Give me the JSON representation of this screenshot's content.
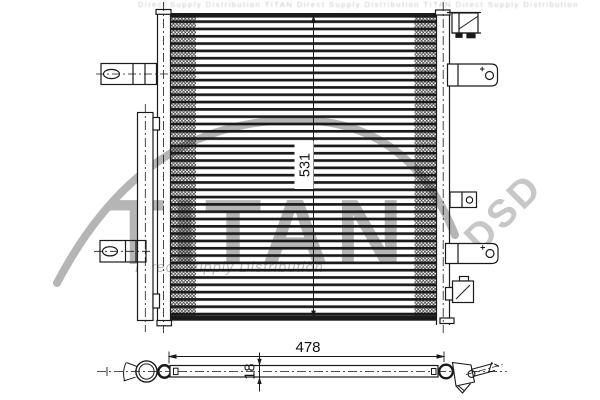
{
  "diagram": {
    "dimensions": {
      "height": "531",
      "width": "478",
      "depth": "18"
    }
  },
  "watermark": {
    "brand": "TITAN",
    "brand_abbr": "DSD",
    "tagline": "Direct Supply Distribution",
    "top_text": "Direct Supply Distribution TITAN Direct Supply Distribution TITAN Direct Supply Distribution"
  },
  "colors": {
    "line": "#1a1a1a",
    "watermark_gray": "#b5b5b5",
    "background": "#ffffff"
  }
}
